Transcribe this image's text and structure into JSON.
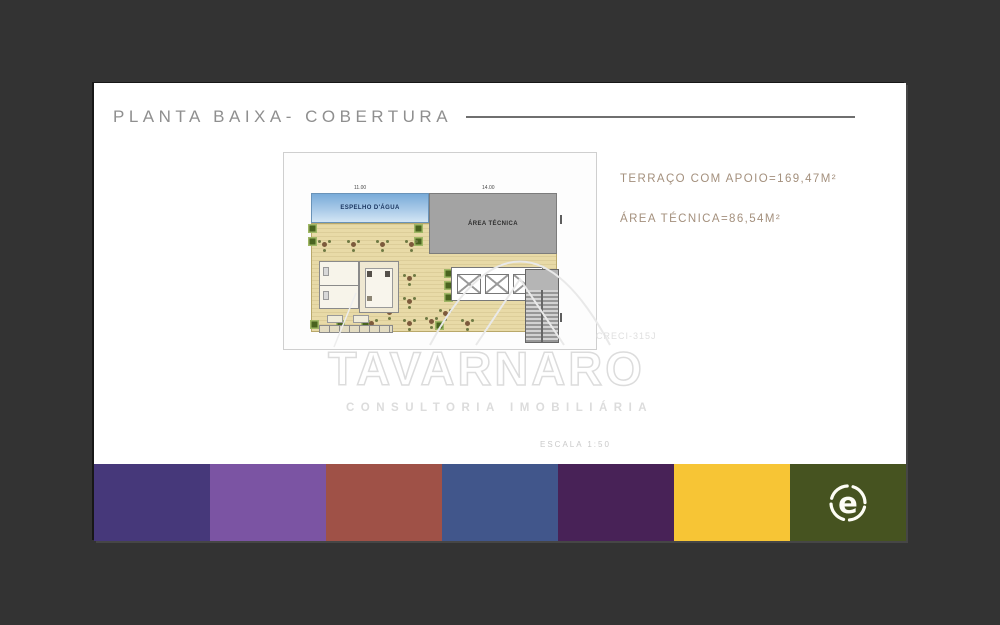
{
  "page": {
    "background": "#333333",
    "card_background": "#ffffff"
  },
  "header": {
    "title": "PLANTA BAIXA- COBERTURA",
    "color": "#8f8f8f"
  },
  "annotations": {
    "terrace": "TERRAÇO COM APOIO=169,47M²",
    "technical": "ÁREA TÉCNICA=86,54M²",
    "color": "#a4907d"
  },
  "plan": {
    "water_mirror_label": "ESPELHO D'ÁGUA",
    "technical_area_label": "ÁREA TÉCNICA",
    "dim_water": "11.00",
    "dim_technical": "14.00"
  },
  "watermark": {
    "brand": "TAVARNARO",
    "subtitle": "CONSULTORIA IMOBILIÁRIA",
    "creci": "CRECI-315J",
    "scale": "ESCALA 1:50"
  },
  "palette": {
    "colors": [
      "#46387a",
      "#7b54a3",
      "#9f5147",
      "#41568b",
      "#482257",
      "#f7c535",
      "#465320"
    ]
  },
  "logo": {
    "letter": "e",
    "color": "#fdfdf5"
  }
}
